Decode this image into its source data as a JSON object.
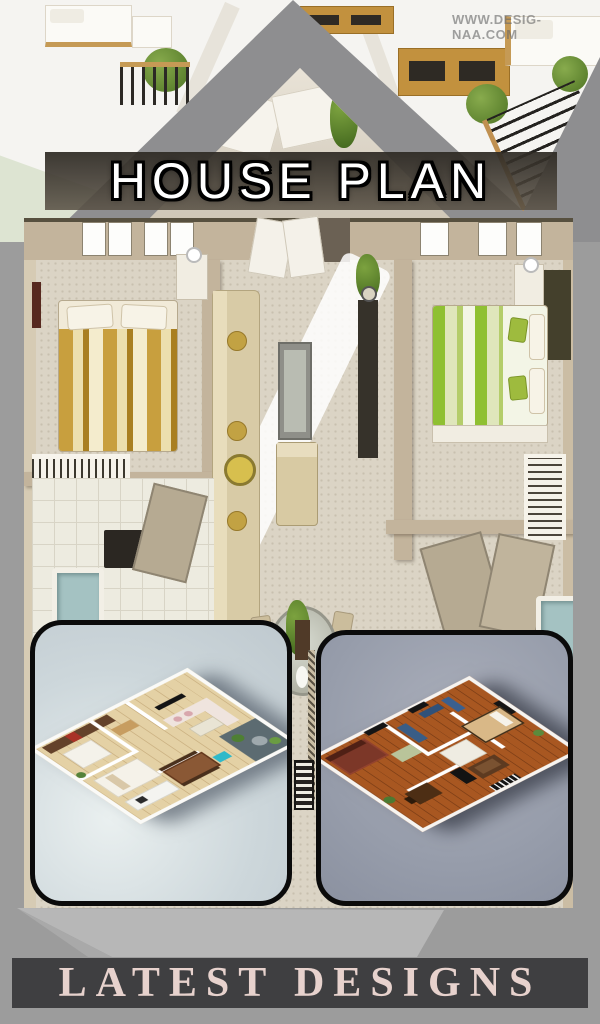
{
  "page": {
    "background_color": "#9c9c9c",
    "roof_color": "#8e8e90"
  },
  "header": {
    "title": "HOUSE PLAN",
    "title_color": "#ffffff",
    "title_outline_color": "#000000",
    "band_color": "#3a352e",
    "watermark": "WWW.DESIG-NAA.COM"
  },
  "main_plan": {
    "wall_color": "#c3b49c",
    "carpet_color": "#dbd4c5",
    "left_bed_accent": "#c89f3e",
    "right_bed_accent": "#8fc032",
    "tub_color": "#a4c2c2"
  },
  "gallery": {
    "cards": [
      {
        "border_color": "#0b0b0b",
        "background": "#cdd7db",
        "floor_color": "#e4d1a5"
      },
      {
        "border_color": "#0b0b0b",
        "background": "#979dab",
        "floor_color": "#a85721"
      }
    ]
  },
  "footer": {
    "label": "LATEST DESIGNS",
    "background": "#3f3f41",
    "text_color": "#e7d2cd",
    "pedestal_color": "#b7b7b7"
  }
}
